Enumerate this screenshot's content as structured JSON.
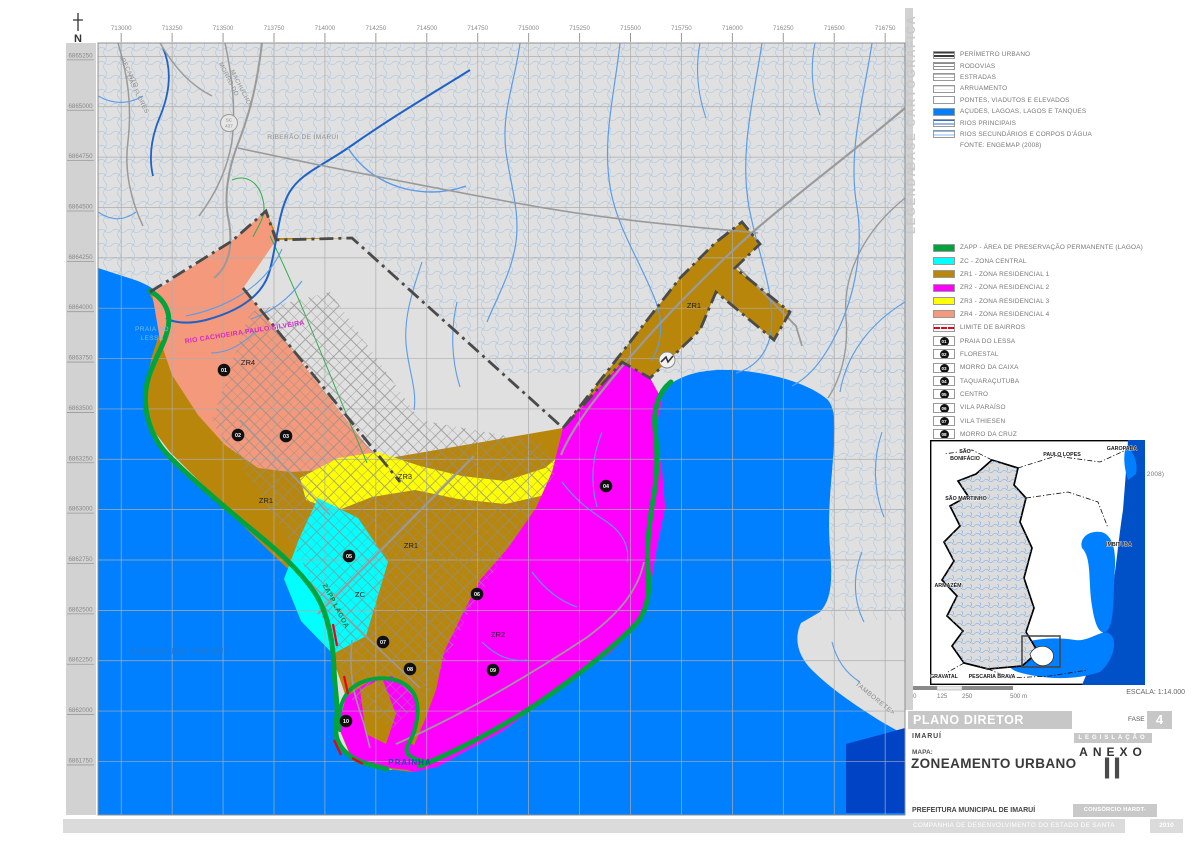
{
  "colors": {
    "water": "#0080FF",
    "water_deep": "#0043C4",
    "land": "#E0E0E0",
    "margin": "#D2D2D2",
    "zapp": "#00A33D",
    "zc": "#00FFFF",
    "zr1": "#B8860B",
    "zr2": "#FF00FF",
    "zr3": "#FFFF00",
    "zr4": "#F4997B",
    "river": "#5A9CE8",
    "river_main": "#1E62C8",
    "road": "#9A9A9A",
    "grid": "#ADADAD",
    "perimeter": "#4A4A4A",
    "bairro": "#E8001C"
  },
  "map": {
    "north_label": "N",
    "road_shield": {
      "line1": "SC",
      "line2": "437"
    },
    "coords_top": [
      "713000",
      "713250",
      "713500",
      "713750",
      "714000",
      "714250",
      "714500",
      "714750",
      "715000",
      "715250",
      "715500",
      "715750",
      "716000",
      "716250",
      "716500",
      "716750"
    ],
    "coords_left": [
      "6865250",
      "6865000",
      "6864750",
      "6864500",
      "6864250",
      "6864000",
      "6863750",
      "6863500",
      "6863250",
      "6863000",
      "6862750",
      "6862500",
      "6862250",
      "6862000",
      "6861750"
    ],
    "zone_labels": [
      {
        "text": "ZR4",
        "x": 248,
        "y": 365
      },
      {
        "text": "ZR1",
        "x": 266,
        "y": 503
      },
      {
        "text": "ZR1",
        "x": 411,
        "y": 548
      },
      {
        "text": "ZR1",
        "x": 694,
        "y": 308
      },
      {
        "text": "ZR3",
        "x": 405,
        "y": 479
      },
      {
        "text": "ZC",
        "x": 360,
        "y": 597
      },
      {
        "text": "ZR2",
        "x": 498,
        "y": 637
      }
    ],
    "markers": [
      {
        "n": "01",
        "x": 224,
        "y": 370
      },
      {
        "n": "02",
        "x": 238,
        "y": 435
      },
      {
        "n": "03",
        "x": 286,
        "y": 436
      },
      {
        "n": "04",
        "x": 606,
        "y": 486
      },
      {
        "n": "05",
        "x": 349,
        "y": 556
      },
      {
        "n": "06",
        "x": 477,
        "y": 594
      },
      {
        "n": "07",
        "x": 383,
        "y": 642
      },
      {
        "n": "08",
        "x": 410,
        "y": 669
      },
      {
        "n": "09",
        "x": 493,
        "y": 670
      },
      {
        "n": "10",
        "x": 346,
        "y": 721
      }
    ],
    "place_labels": [
      {
        "text": "PRAIA DO",
        "x": 152,
        "y": 331,
        "size": 6.5,
        "color": "#74BFEA",
        "rot": 0,
        "ls": 0.4,
        "w": 400
      },
      {
        "text": "LESSA",
        "x": 152,
        "y": 340,
        "size": 6.5,
        "color": "#74BFEA",
        "rot": 0,
        "ls": 0.4,
        "w": 400
      },
      {
        "text": "RIO CACHOEIRA PAULO SILVEIRA",
        "x": 245,
        "y": 334,
        "size": 6.8,
        "color": "#D428C8",
        "rot": -9,
        "ls": 0.3,
        "w": 600
      },
      {
        "text": "RIBERÃO DE IMARUI",
        "x": 303,
        "y": 139,
        "size": 6.5,
        "color": "#909090",
        "rot": 0,
        "ls": 0.4,
        "w": 400
      },
      {
        "text": "<RECANTO",
        "x": 127,
        "y": 72,
        "size": 6.2,
        "color": "#909090",
        "rot": 63,
        "ls": 0.3,
        "w": 400
      },
      {
        "text": "DAS FLORES",
        "x": 136,
        "y": 95,
        "size": 6.2,
        "color": "#909090",
        "rot": 63,
        "ls": 0.3,
        "w": 400
      },
      {
        "text": "MORRO DO",
        "x": 227,
        "y": 80,
        "size": 6.2,
        "color": "#909090",
        "rot": 63,
        "ls": 0.3,
        "w": 400
      },
      {
        "text": "MACHUCHO>",
        "x": 240,
        "y": 90,
        "size": 6.2,
        "color": "#909090",
        "rot": 63,
        "ls": 0.3,
        "w": 400
      },
      {
        "text": "TAMBORETE>",
        "x": 874,
        "y": 700,
        "size": 6.5,
        "color": "#8A8A8A",
        "rot": 39,
        "ls": 0.5,
        "w": 400
      },
      {
        "text": "ZAPP LAGOA",
        "x": 334,
        "y": 607,
        "size": 6.8,
        "color": "#0A7F38",
        "rot": 62,
        "ls": 0.5,
        "w": 600
      },
      {
        "text": "LAGOA DO IMARUÍ",
        "x": 180,
        "y": 654,
        "size": 8,
        "color": "#1F78D1",
        "rot": 0,
        "ls": 1.6,
        "w": 600
      },
      {
        "text": "PRAINHA",
        "x": 410,
        "y": 765,
        "size": 8,
        "color": "#1D4FA8",
        "rot": 0,
        "ls": 1,
        "w": 600
      }
    ]
  },
  "legend": {
    "side_label_top": "BASE CARTOGRÁFICA",
    "side_label_bottom": "LEGENDA",
    "base_items": [
      {
        "label": "PERÍMETRO URBANO",
        "kind": "perimetro"
      },
      {
        "label": "RODOVIAS",
        "kind": "rodovias"
      },
      {
        "label": "ESTRADAS",
        "kind": "estradas"
      },
      {
        "label": "ARRUAMENTO",
        "kind": "arruamento"
      },
      {
        "label": "PONTES, VIADUTOS E ELEVADOS",
        "kind": "ponte"
      },
      {
        "label": "AÇUDES, LAGOAS, LAGOS E TANQUES",
        "kind": "fill",
        "color": "#0080FF"
      },
      {
        "label": "RIOS PRINCIPAIS",
        "kind": "rios1"
      },
      {
        "label": "RIOS SECUNDÁRIOS E CORPOS D'ÁGUA",
        "kind": "rios2"
      },
      {
        "label": "FONTE: ENGEMAP (2008)",
        "kind": "none"
      }
    ],
    "zone_items": [
      {
        "label": "ZAPP - ÁREA DE PRESERVAÇÃO PERMANENTE (LAGOA)",
        "kind": "fill",
        "color": "#00A33D"
      },
      {
        "label": "ZC - ZONA CENTRAL",
        "kind": "fill",
        "color": "#00FFFF"
      },
      {
        "label": "ZR1 - ZONA RESIDENCIAL 1",
        "kind": "fill",
        "color": "#B8860B"
      },
      {
        "label": "ZR2 - ZONA RESIDENCIAL 2",
        "kind": "fill",
        "color": "#FF00FF"
      },
      {
        "label": "ZR3 - ZONA RESIDENCIAL 3",
        "kind": "fill",
        "color": "#FFFF00"
      },
      {
        "label": "ZR4 - ZONA RESIDENCIAL 4",
        "kind": "fill",
        "color": "#F4997B"
      },
      {
        "label": "LIMITE DE BAIRROS",
        "kind": "dashred"
      },
      {
        "label": "PRAIA DO LESSA",
        "kind": "marker",
        "num": "01"
      },
      {
        "label": "FLORESTAL",
        "kind": "marker",
        "num": "02"
      },
      {
        "label": "MORRO DA CAIXA",
        "kind": "marker",
        "num": "03"
      },
      {
        "label": "TAQUARAÇUTUBA",
        "kind": "marker",
        "num": "04"
      },
      {
        "label": "CENTRO",
        "kind": "marker",
        "num": "05"
      },
      {
        "label": "VILA PARAÍSO",
        "kind": "marker",
        "num": "06"
      },
      {
        "label": "VILA THIESEN",
        "kind": "marker",
        "num": "07"
      },
      {
        "label": "MORRO DA CRUZ",
        "kind": "marker",
        "num": "08"
      },
      {
        "label": "PRAINHA",
        "kind": "marker",
        "num": "09"
      },
      {
        "label": "PRAIA DA ROSA",
        "kind": "marker",
        "num": "10"
      },
      {
        "label": "FONTE: CONSÓRCIO HARDT-ENGEMIN (2010), PMI (2003, 2008)",
        "kind": "none"
      }
    ]
  },
  "inset": {
    "labels": [
      {
        "text": "SÃO",
        "x": 35,
        "y": 13
      },
      {
        "text": "BONIFÁCIO",
        "x": 35,
        "y": 20
      },
      {
        "text": "PAULO LOPES",
        "x": 132,
        "y": 16
      },
      {
        "text": "GAROPABA",
        "x": 192,
        "y": 10
      },
      {
        "text": "SÃO MARTINHO",
        "x": 36,
        "y": 60
      },
      {
        "text": "IMBITUBA",
        "x": 189,
        "y": 106
      },
      {
        "text": "ARMAZÉM",
        "x": 18,
        "y": 147
      },
      {
        "text": "GRAVATAL",
        "x": 14,
        "y": 238
      },
      {
        "text": "PESCARIA BRAVA",
        "x": 62,
        "y": 238
      }
    ]
  },
  "scalebar": {
    "ticks": [
      {
        "label": "0",
        "x": 0
      },
      {
        "label": "125",
        "x": 24
      },
      {
        "label": "250",
        "x": 49
      },
      {
        "label": "500 m",
        "x": 97
      }
    ],
    "escala": "ESCALA: 1:14.000"
  },
  "titleblock": {
    "title": "PLANO DIRETOR MUNICIPAL",
    "fase_label": "FASE",
    "fase_value": "4",
    "municipio": "IMARUÍ",
    "legislacao": "LEGISLAÇÃO",
    "anexo": "ANEXO",
    "anexo_value": "II",
    "mapa_label": "MAPA:",
    "mapa_value": "ZONEAMENTO URBANO",
    "prefeitura": "PREFEITURA MUNICIPAL DE IMARUÍ",
    "consorcio": "CONSÓRCIO HARDT-ENGEMIN",
    "companhia": "COMPANHIA DE DESENVOLVIMENTO DO ESTADO DE SANTA CATARINA",
    "ano": "2010"
  }
}
